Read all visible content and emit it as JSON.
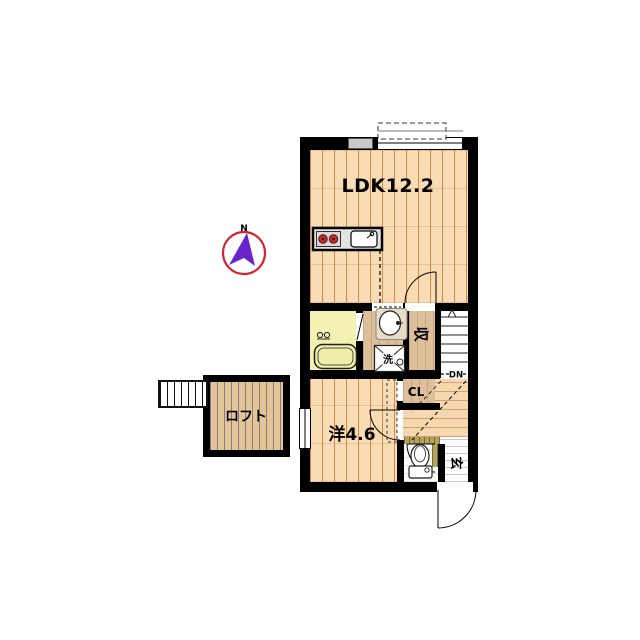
{
  "title": "apartment-floor-plan",
  "labels": {
    "ldk": "LDK12.2",
    "western": "洋4.6",
    "loft": "ロフト",
    "storage": "収",
    "closet": "CL",
    "stairs_down": "DN",
    "entrance": "玄",
    "laundry": "洗",
    "north": "N"
  },
  "icons": [
    "compass-icon",
    "kitchen-stove-icon",
    "kitchen-sink-icon",
    "bathtub-icon",
    "bath-faucet-icon",
    "washbasin-icon",
    "washing-machine-icon",
    "toilet-icon",
    "stairs-icon",
    "up-arrow-icon",
    "door-arc",
    "window",
    "balcony-outline",
    "loft-ladder-icon"
  ],
  "colors": {
    "wall": "#000000",
    "wood_floor": "#f8dcb4",
    "wood_line": "#d4874e",
    "bathroom": "#f3f2b2",
    "service_tan": "#ddbf99",
    "loft_floor": "#e3c695",
    "step_olive": "#b3a35b",
    "compass_ring": "#d9202f",
    "compass_needle": "#6a23cc",
    "stove_burner": "#c03030"
  }
}
